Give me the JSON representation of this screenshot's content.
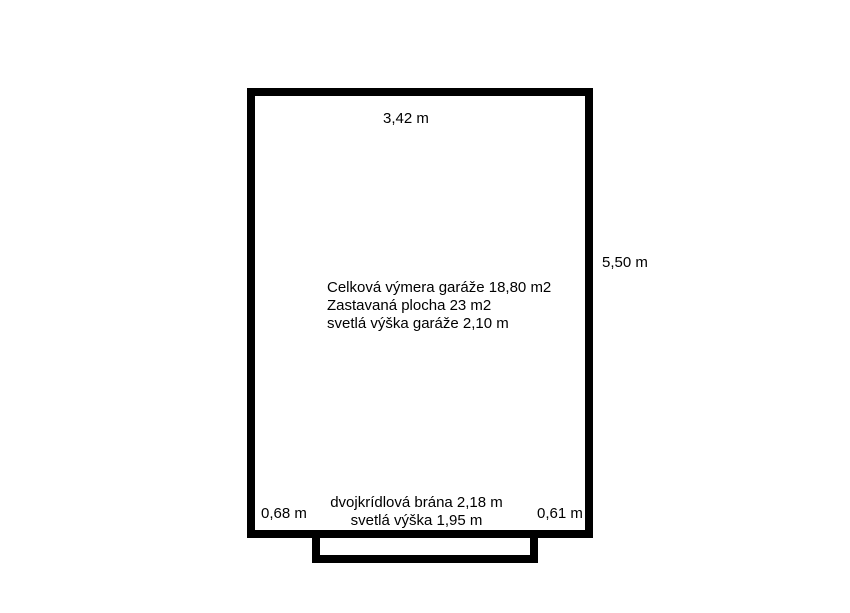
{
  "colors": {
    "outline": "#000000",
    "background": "#ffffff",
    "text": "#000000"
  },
  "floorplan": {
    "top_width_label": "3,42 m",
    "right_height_label": "5,50 m",
    "info_lines": [
      "Celková výmera garáže 18,80 m2",
      "Zastavaná plocha 23 m2",
      "svetlá výška garáže 2,10 m"
    ],
    "gate_label_line1": "dvojkrídlová brána 2,18 m",
    "gate_label_line2": "svetlá výška 1,95 m",
    "left_offset_label": "0,68 m",
    "right_offset_label": "0,61 m"
  }
}
